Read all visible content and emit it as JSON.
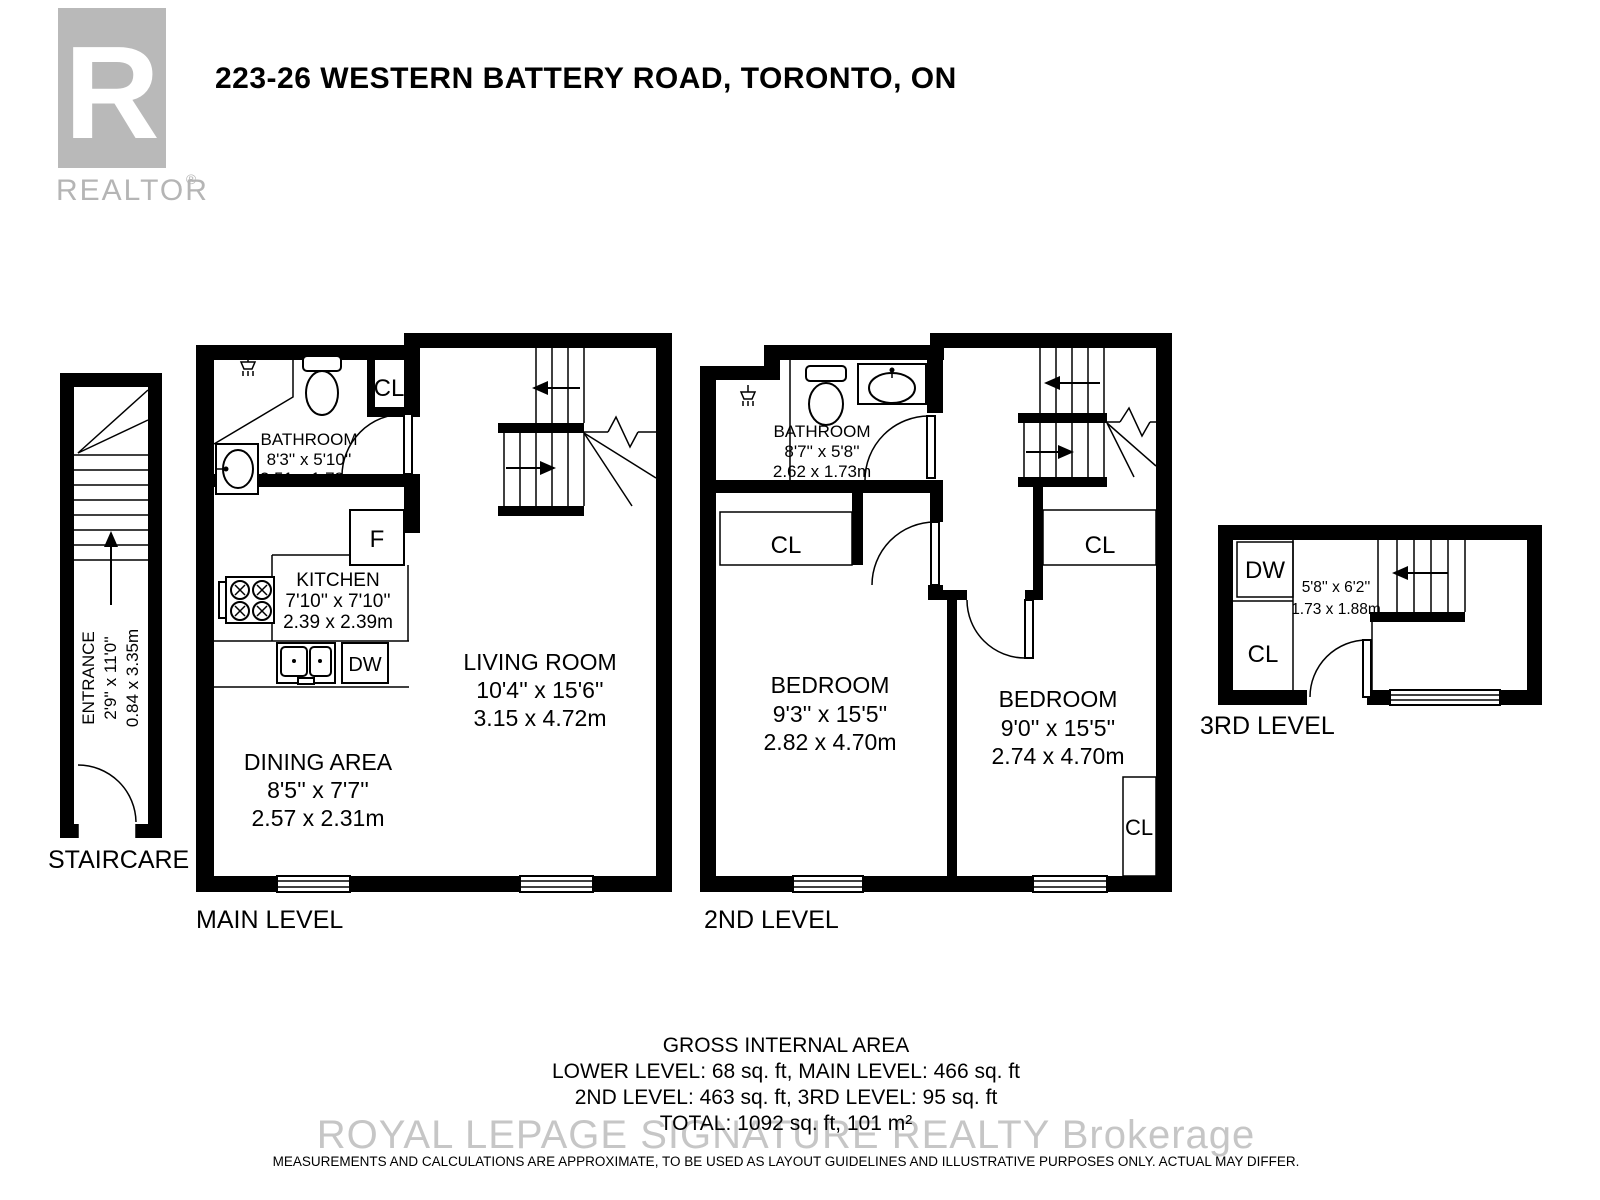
{
  "header": {
    "title": "223-26 WESTERN BATTERY ROAD, TORONTO, ON",
    "logo_r": "R",
    "logo_text": "REALTOR",
    "logo_reg": "®"
  },
  "staircase": {
    "level_label": "STAIRCARE",
    "room_name": "ENTRANCE",
    "imperial": "2'9'' x 11'0''",
    "metric": "0.84 x 3.35m"
  },
  "main_level": {
    "level_label": "MAIN LEVEL",
    "bathroom": {
      "name": "BATHROOM",
      "imperial": "8'3'' x 5'10''",
      "metric": "2.51 x 1.78m"
    },
    "kitchen": {
      "name": "KITCHEN",
      "imperial": "7'10'' x 7'10''",
      "metric": "2.39 x 2.39m"
    },
    "living_room": {
      "name": "LIVING ROOM",
      "imperial": "10'4'' x 15'6''",
      "metric": "3.15 x 4.72m"
    },
    "dining_area": {
      "name": "DINING AREA",
      "imperial": "8'5'' x 7'7''",
      "metric": "2.57 x 2.31m"
    },
    "closet": "CL",
    "fridge": "F",
    "dishwasher": "DW"
  },
  "second_level": {
    "level_label": "2ND LEVEL",
    "bathroom": {
      "name": "BATHROOM",
      "imperial": "8'7'' x 5'8''",
      "metric": "2.62 x 1.73m"
    },
    "bedroom_left": {
      "name": "BEDROOM",
      "imperial": "9'3'' x 15'5''",
      "metric": "2.82 x 4.70m"
    },
    "bedroom_right": {
      "name": "BEDROOM",
      "imperial": "9'0'' x 15'5''",
      "metric": "2.74 x 4.70m"
    },
    "closet_left": "CL",
    "closet_right": "CL",
    "closet_bedroom": "CL"
  },
  "third_level": {
    "level_label": "3RD LEVEL",
    "imperial": "5'8'' x 6'2''",
    "metric": "1.73 x 1.88m",
    "dishwasher": "DW",
    "closet": "CL"
  },
  "footer": {
    "area_title": "GROSS INTERNAL AREA",
    "area_line1": "LOWER LEVEL: 68 sq. ft, MAIN LEVEL: 466 sq. ft",
    "area_line2": "2ND LEVEL: 463 sq. ft, 3RD LEVEL: 95 sq. ft",
    "area_line3": "TOTAL: 1092 sq. ft, 101 m²",
    "watermark": "ROYAL LEPAGE SIGNATURE REALTY  Brokerage",
    "disclaimer": "MEASUREMENTS AND CALCULATIONS ARE APPROXIMATE, TO BE USED AS LAYOUT GUIDELINES AND ILLUSTRATIVE PURPOSES ONLY.  ACTUAL MAY DIFFER."
  }
}
